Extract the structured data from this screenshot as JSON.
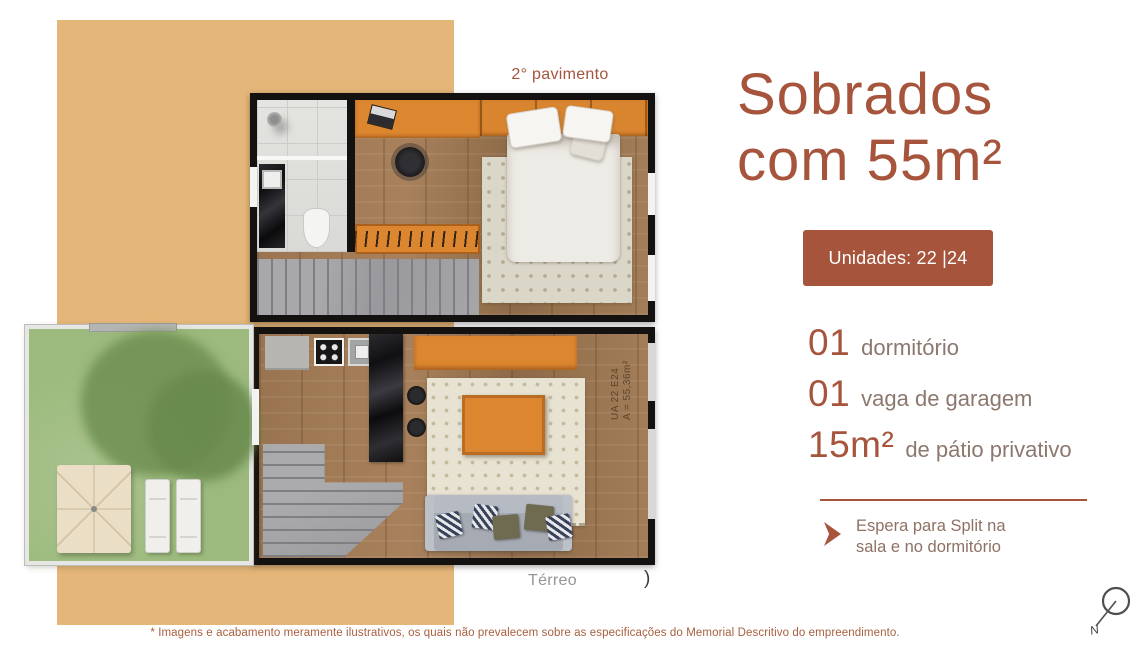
{
  "page": {
    "background": "#ffffff",
    "tan_block_color": "#e4b679",
    "accent_color": "#a6543c",
    "muted_label_color": "#8c786e"
  },
  "plan_upper": {
    "label": "2° pavimento"
  },
  "plan_ground": {
    "label": "Térreo",
    "mark": ")",
    "unit_line1": "UA 22 E24",
    "unit_line2": "A = 55,36m²"
  },
  "panel": {
    "title_line1": "Sobrados",
    "title_line2": "com 55m²",
    "badge_label": "Unidades: 22 |24",
    "features": [
      {
        "value": "01",
        "label": "dormitório"
      },
      {
        "value": "01",
        "label": "vaga de garagem"
      },
      {
        "value": "15m²",
        "label": "de pátio privativo"
      }
    ],
    "note_line1": "Espera para Split na",
    "note_line2": "sala e no dormitório"
  },
  "footer": {
    "disclaimer": "* Imagens e acabamento meramente ilustrativos, os quais não prevalecem sobre as especificações do Memorial Descritivo do empreendimento."
  },
  "compass": {
    "label": "N"
  }
}
